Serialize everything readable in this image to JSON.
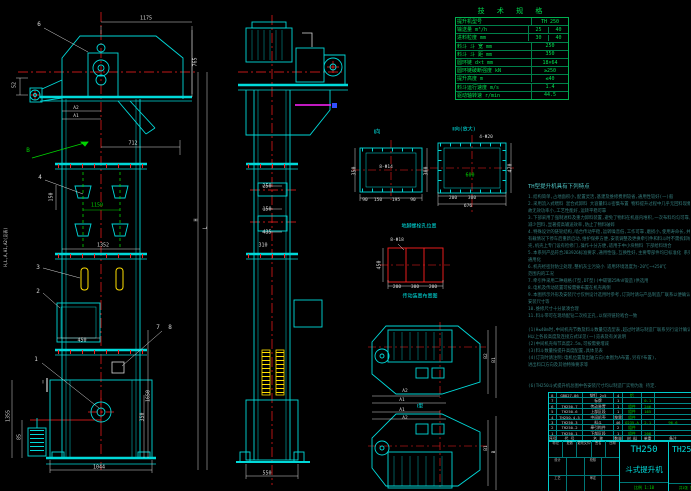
{
  "drawing": {
    "colors": {
      "background": "#000000",
      "line_cyan": "#00d9d9",
      "centerline_red": "#ff1f1f",
      "dim_white": "#d9d9d9",
      "text_green": "#00d400",
      "bucket_yellow": "#ffdf00",
      "highlight_magenta": "#ff22ff",
      "notes_teal": "#357f7f"
    },
    "spec_table": {
      "title": "技 术 规 格",
      "rows": [
        [
          "提升机型号",
          "TH 250"
        ],
        [
          "输送量 m³/h",
          "25",
          "40"
        ],
        [
          "进料粒度 mm",
          "30",
          "40"
        ],
        [
          "料斗 斗 宽 mm",
          "250"
        ],
        [
          "料斗 斗 距 mm",
          "350"
        ],
        [
          "圆环链 d×t mm",
          "18×64"
        ],
        [
          "圆环链破断强度 kN",
          "≥250"
        ],
        [
          "提升高度 m",
          "≤40"
        ],
        [
          "料斗运行速度 m/s",
          "1.4"
        ],
        [
          "驱动轴转速 r/min",
          "44.5"
        ]
      ]
    },
    "notes": {
      "title": "TH型提升机具有下列特点",
      "lines": [
        "1.结构简单,占地面积小,配置灵活,基建及维修费用较省,通用性较好(一)般",
        "2.采用流入式喂料 混合式卸料 大容量料斗密集布置 物料提升过程中几乎无回料现象",
        "  故无效功率小,工艺性能好,运转平稳可靠",
        "3.下部采用了强制进料及重力卸料装置,避免了物料在机座内堆积,一次布料均匀可靠,大大",
        "  减少回料,显著提高输送效率,防止了物料破碎",
        "4.特殊设计的链轮结构,啮合传动平稳,运转噪音低,工作可靠,磨损小,使用寿命长,并可在",
        "  有载情况下停车后重新启动,维护保养方便,安装调整及更换牵引件和料斗时不需拆卸机",
        "  壳,机壳上专门设有检修门,操作十分方便,适用于中小块物料 下部给料场合",
        "5.本系列产品符合JB3926标准要求,通用性强,互换性好,主要零部件均已标准化 系列化",
        "  通用化",
        "6.机壳经密封防尘处理,整机灰尘污染小            适用环境温度为-20℃~+250℃",
        "  范围内的工况",
        "7.牵引件采用二种规格(T型,DT型)(中碳钢25MnV锻造)供选用",
        "8.电机及传动装置可按需要布置在机壳两侧",
        "9.本图所示外形及安装尺寸仅供设计选用时参考,订货时请与产品制造厂联系以便确认最终",
        "  安装尺寸等",
        "10.维修尺寸十分紧凑合理",
        "11.料斗带可在现场配钻二次校正孔,以保持链轮啮合一致",
        "",
        "(1)H≤40m时,中间机壳节数及料斗数量见选型表,超过时请与制造厂联系另行设计确认",
        "  H以上各段高度及连接方式详见(一)览表及有关说明",
        "(2)中间机壳每节高度2.5m,可按需要增减",
        "(3)料斗数量按提升高度配置,具体见表",
        "(4)订货时请注明:电机位置及出轴方向(本图为A布置,另有Y布置),",
        "  进出料口方向及其他特殊要求等",
        "",
        "",
        "(6)TH250斗式提升机总图中各安装尺寸均以制造厂实物为准 待定."
      ]
    },
    "bom": {
      "header": [
        "序号",
        "代  号",
        "名  称",
        "数量",
        "材 料",
        "单重",
        "备注"
      ],
      "rows": [
        [
          "8",
          "GB827-86",
          "铆钉 2×5",
          "4",
          "铝",
          "",
          ""
        ],
        [
          "7",
          "",
          "标牌",
          "1",
          "",
          "0.1",
          ""
        ],
        [
          "6",
          "TH250.7",
          "传动装置",
          "1",
          "组件",
          "246",
          ""
        ],
        [
          "5",
          "TH250.6",
          "上部区段",
          "1",
          "组件",
          "165",
          ""
        ],
        [
          "4",
          "TH250.4,5",
          "中间机壳",
          "按需",
          "组件",
          "",
          ""
        ],
        [
          "3",
          "TH250.3",
          "料斗",
          "46",
          "Q235-A",
          "2.1",
          "96.6"
        ],
        [
          "2",
          "TH250.2",
          "牵引构件",
          "2",
          "组件",
          "",
          ""
        ],
        [
          "1",
          "TH250.1",
          "下部区段",
          "1",
          "组件",
          "208",
          ""
        ]
      ]
    },
    "title_block": {
      "model": "TH250",
      "product_name": "斗式提升机",
      "drawing_no": "TH250",
      "scale_label": "比例 1:10",
      "sheet_label": "共1张 第1张",
      "left_rows": [
        [
          "标记",
          "处数",
          "更改文件号",
          "签名",
          "日期"
        ],
        [
          "设计",
          "",
          "校核",
          ""
        ],
        [
          "工艺",
          "",
          "审定",
          ""
        ]
      ]
    },
    "annotations": [
      {
        "t": "1175",
        "x": 146,
        "y": 19
      },
      {
        "t": "6",
        "x": 39,
        "y": 25,
        "s": 6
      },
      {
        "t": "765",
        "x": 196,
        "y": 62,
        "r": 1
      },
      {
        "t": "52",
        "x": 15,
        "y": 85,
        "r": 1
      },
      {
        "t": "A2",
        "x": 76,
        "y": 109,
        "s": 4.5
      },
      {
        "t": "A1",
        "x": 76,
        "y": 117,
        "s": 4.5
      },
      {
        "t": "712",
        "x": 133,
        "y": 144
      },
      {
        "t": "B",
        "x": 28,
        "y": 151,
        "c": "g",
        "s": 6
      },
      {
        "t": "4",
        "x": 40,
        "y": 178,
        "s": 6
      },
      {
        "t": "150",
        "x": 52,
        "y": 197,
        "r": 1
      },
      {
        "t": "1150",
        "x": 97,
        "y": 206,
        "c": "g"
      },
      {
        "t": "1352",
        "x": 103,
        "y": 246
      },
      {
        "t": "3",
        "x": 38,
        "y": 268,
        "s": 6
      },
      {
        "t": "2",
        "x": 38,
        "y": 292,
        "s": 6
      },
      {
        "t": "450",
        "x": 82,
        "y": 341
      },
      {
        "t": "7",
        "x": 158,
        "y": 328,
        "s": 6
      },
      {
        "t": "8",
        "x": 170,
        "y": 328,
        "s": 6
      },
      {
        "t": "1",
        "x": 36,
        "y": 360,
        "s": 6
      },
      {
        "t": "Ⅰ",
        "x": 43,
        "y": 383
      },
      {
        "t": "1355",
        "x": 9,
        "y": 416,
        "r": 1
      },
      {
        "t": "85",
        "x": 20,
        "y": 437,
        "r": 1
      },
      {
        "t": "1650",
        "x": 149,
        "y": 396,
        "r": 1
      },
      {
        "t": "350",
        "x": 143,
        "y": 417,
        "r": 1
      },
      {
        "t": "1044",
        "x": 99,
        "y": 468
      },
      {
        "t": "H",
        "x": 197,
        "y": 220,
        "r": 1
      },
      {
        "t": "L",
        "x": 206,
        "y": 228,
        "r": 1
      },
      {
        "t": "H,L,A,A1,A2(见表)",
        "x": 6,
        "y": 247,
        "r": 1,
        "s": 4
      },
      {
        "t": "250",
        "x": 267,
        "y": 187
      },
      {
        "t": "150",
        "x": 267,
        "y": 210
      },
      {
        "t": "435",
        "x": 267,
        "y": 233
      },
      {
        "t": "310",
        "x": 263,
        "y": 246
      },
      {
        "t": "550",
        "x": 267,
        "y": 474
      },
      {
        "t": "Ⅰ向",
        "x": 377,
        "y": 133,
        "c": "c",
        "s": 5.5
      },
      {
        "t": "8-Φ14",
        "x": 386,
        "y": 168,
        "s": 4.5
      },
      {
        "t": "350",
        "x": 355,
        "y": 171,
        "r": 1
      },
      {
        "t": "300",
        "x": 427,
        "y": 171,
        "r": 1
      },
      {
        "t": "90",
        "x": 365,
        "y": 201,
        "s": 4.5
      },
      {
        "t": "150",
        "x": 378,
        "y": 201,
        "s": 4.5
      },
      {
        "t": "195",
        "x": 396,
        "y": 201,
        "s": 4.5
      },
      {
        "t": "90",
        "x": 413,
        "y": 201,
        "s": 4.5
      },
      {
        "t": "Ⅱ向(放大)",
        "x": 464,
        "y": 130,
        "c": "c",
        "s": 5
      },
      {
        "t": "4-Φ20",
        "x": 486,
        "y": 138,
        "s": 4.5
      },
      {
        "t": "600",
        "x": 470,
        "y": 176,
        "c": "g"
      },
      {
        "t": "470",
        "x": 511,
        "y": 168,
        "r": 1
      },
      {
        "t": "200",
        "x": 453,
        "y": 199,
        "s": 4.5
      },
      {
        "t": "300",
        "x": 472,
        "y": 199,
        "s": 4.5
      },
      {
        "t": "676",
        "x": 468,
        "y": 207,
        "s": 4.5
      },
      {
        "t": "地脚螺栓孔位置",
        "x": 419,
        "y": 227,
        "c": "c",
        "s": 5
      },
      {
        "t": "8-Φ18",
        "x": 397,
        "y": 241,
        "s": 4.5
      },
      {
        "t": "450",
        "x": 380,
        "y": 265,
        "r": 1
      },
      {
        "t": "200",
        "x": 397,
        "y": 288,
        "s": 4.5
      },
      {
        "t": "300",
        "x": 415,
        "y": 288,
        "s": 4.5
      },
      {
        "t": "200",
        "x": 433,
        "y": 288,
        "s": 4.5
      },
      {
        "t": "传动装置布置图",
        "x": 420,
        "y": 297,
        "c": "c",
        "s": 5
      },
      {
        "t": "A2",
        "x": 405,
        "y": 392,
        "s": 4.5
      },
      {
        "t": "A1",
        "x": 402,
        "y": 401,
        "s": 4.5
      },
      {
        "t": "B2",
        "x": 487,
        "y": 356,
        "s": 4.5,
        "r": 1
      },
      {
        "t": "B1",
        "x": 495,
        "y": 360,
        "s": 4.5,
        "r": 1
      },
      {
        "t": "Ⅰ型",
        "x": 420,
        "y": 407,
        "c": "c",
        "s": 5
      },
      {
        "t": "A1",
        "x": 402,
        "y": 411,
        "s": 4.5
      },
      {
        "t": "A2",
        "x": 405,
        "y": 419,
        "s": 4.5
      },
      {
        "t": "B1",
        "x": 487,
        "y": 448,
        "s": 4.5,
        "r": 1
      },
      {
        "t": "B",
        "x": 495,
        "y": 452,
        "s": 4.5,
        "r": 1
      }
    ]
  }
}
